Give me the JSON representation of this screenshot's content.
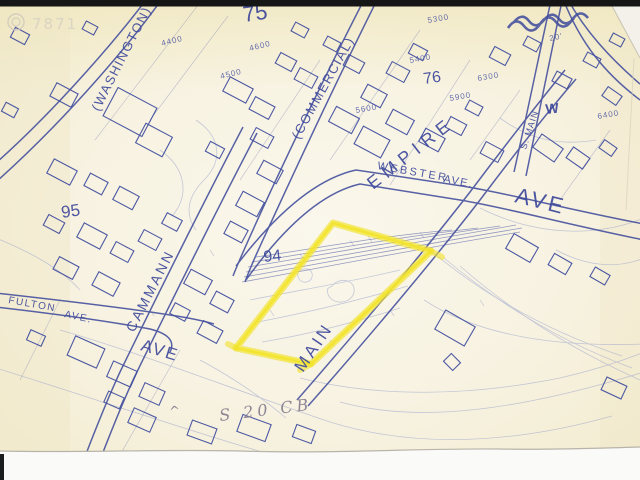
{
  "scan": {
    "watermark_text": "7871",
    "handwritten_note": "S 20 CB",
    "handwritten_caret": "^",
    "colors": {
      "paper": "#f6f1dc",
      "ink": "#4a55a3",
      "highlight": "#f3e337",
      "top_bar": "#161616"
    }
  },
  "map": {
    "street_labels": {
      "washington": "(WASHINGTON)",
      "commercial": "(COMMERCIAL)",
      "cammann": "CAMMANN",
      "cammann_ave": "AVE",
      "fulton": "FULTON",
      "fulton_ave": "AVE.",
      "webster": "WEBSTER",
      "webster_ave": "AVE.",
      "empire": "EMPIRE",
      "empire_ave": "AVE",
      "main": "MAIN",
      "s_main": "S. MAIN"
    },
    "block_numbers": {
      "b75": "75",
      "b76": "76",
      "b94": "94",
      "b95": "95"
    },
    "lot_numbers": {
      "l4400": "4400",
      "l4500": "4500",
      "l4600": "4600",
      "l5300": "5300",
      "l5400": "5400",
      "l5600": "5600",
      "l5900": "5900",
      "l6300": "6300",
      "l6400": "6400"
    },
    "annotations": {
      "water_mark": "W",
      "dim_20": "20'"
    }
  }
}
